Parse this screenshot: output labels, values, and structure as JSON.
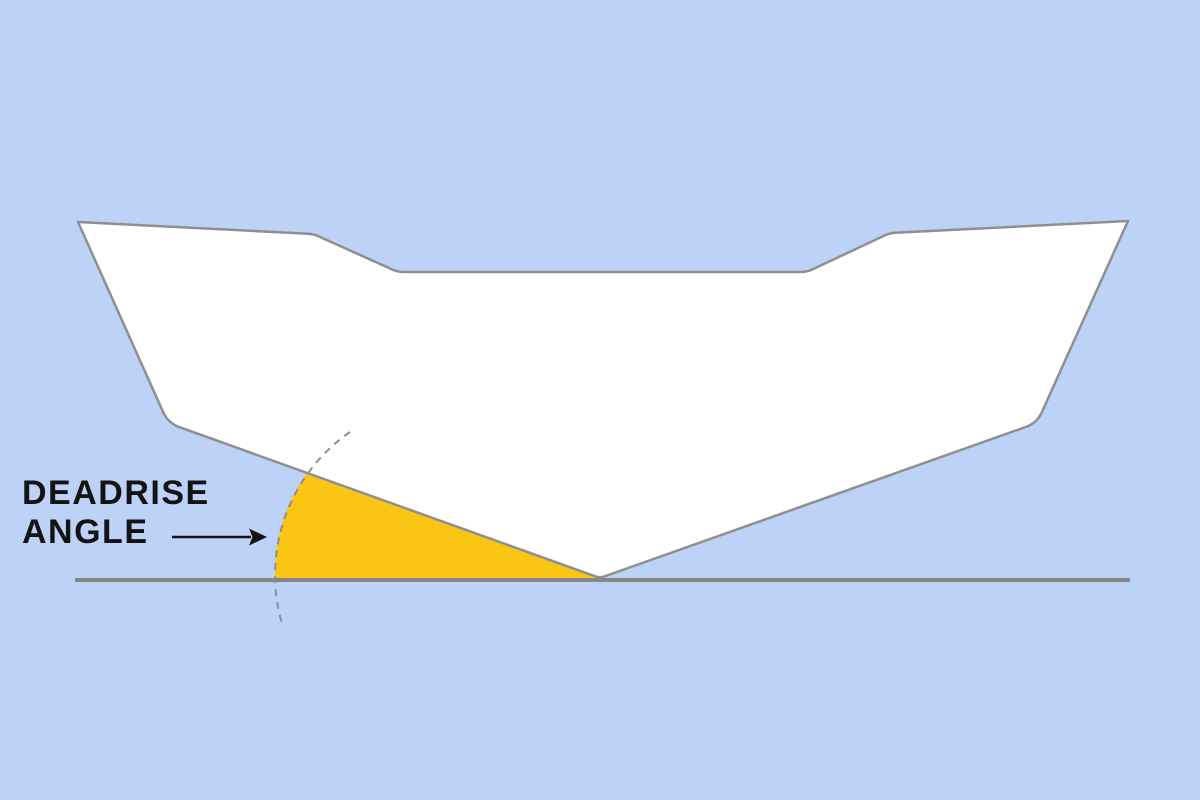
{
  "label": {
    "line1": "DEADRISE",
    "line2": "ANGLE"
  },
  "colors": {
    "background": "#bdd2f7",
    "hull-fill": "#ffffff",
    "hull-outline": "#8f8f8f",
    "baseline": "#868686",
    "angle-fill": "#fbc513",
    "arc": "#8f8f8f",
    "label-text": "#131313"
  }
}
